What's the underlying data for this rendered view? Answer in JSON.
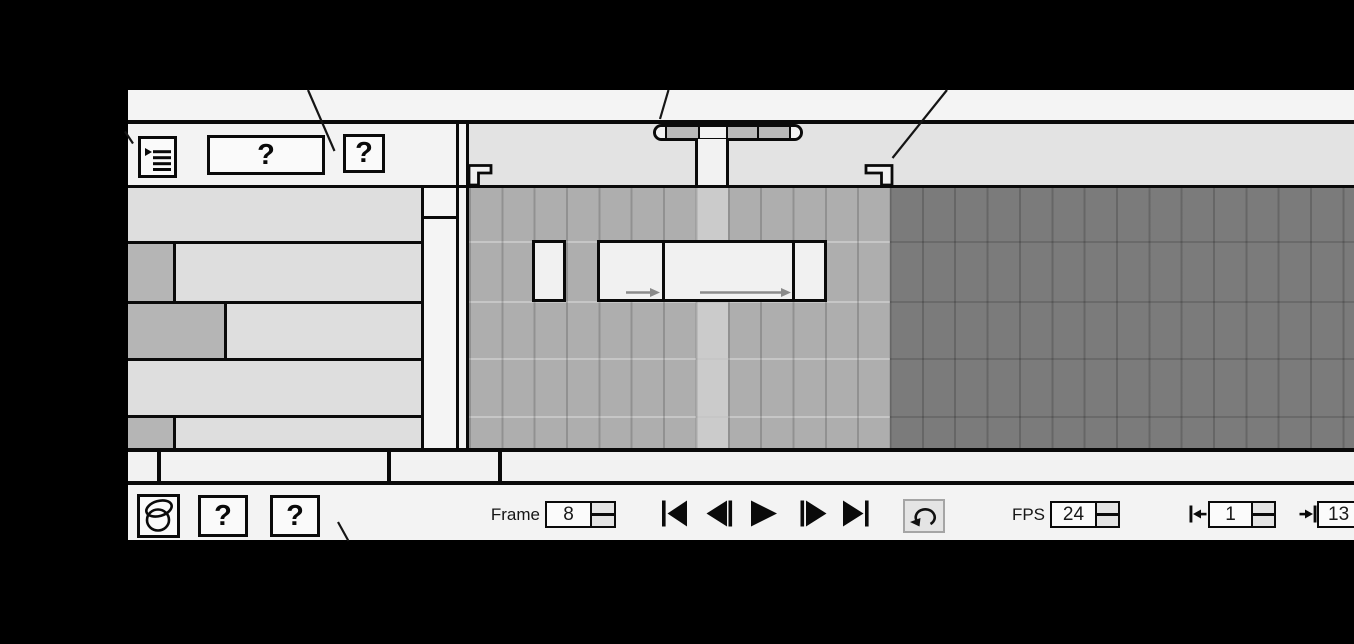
{
  "panel": {
    "header": {
      "menu_button_icon": "panel-menu-icon",
      "name_placeholder": "?",
      "small_placeholder": "?"
    },
    "ruler": {
      "onion_marker_frames": "6-10",
      "playhead_frame": 8,
      "range_start_marker_frame": 1,
      "range_end_marker_frame": 13
    },
    "timeline": {
      "current_frame": 8,
      "last_movie_frame": 13,
      "layer_rows": 5,
      "spans": [
        {
          "frames": "3",
          "tween_arrow": false
        },
        {
          "frames": "5-6",
          "tween_arrow": true
        },
        {
          "frames": "7-10",
          "tween_arrow": true
        },
        {
          "frames": "11",
          "tween_arrow": false
        }
      ]
    },
    "transport": {
      "onion_skin_icon": "onion-skin-icon",
      "placeholder_a": "?",
      "placeholder_b": "?",
      "frame_label": "Frame",
      "frame_value": "8",
      "buttons": [
        "jump-to-start",
        "step-back",
        "play",
        "step-forward",
        "jump-to-end"
      ],
      "loop_icon": "loop-icon",
      "fps_label": "FPS",
      "fps_value": "24",
      "range_start_value": "1",
      "range_end_value": "13"
    },
    "colors": {
      "background": "#000000",
      "panel": "#f3f3f3",
      "ruler": "#e3e3e3",
      "layer_row": "#dedede",
      "layer_selected_block": "#b5b5b5",
      "grid_light": "#aeaeae",
      "grid_current_column": "#cbcbcb",
      "grid_dark": "#7b7b7b",
      "keyframe_span": "#f1f1f1"
    }
  }
}
